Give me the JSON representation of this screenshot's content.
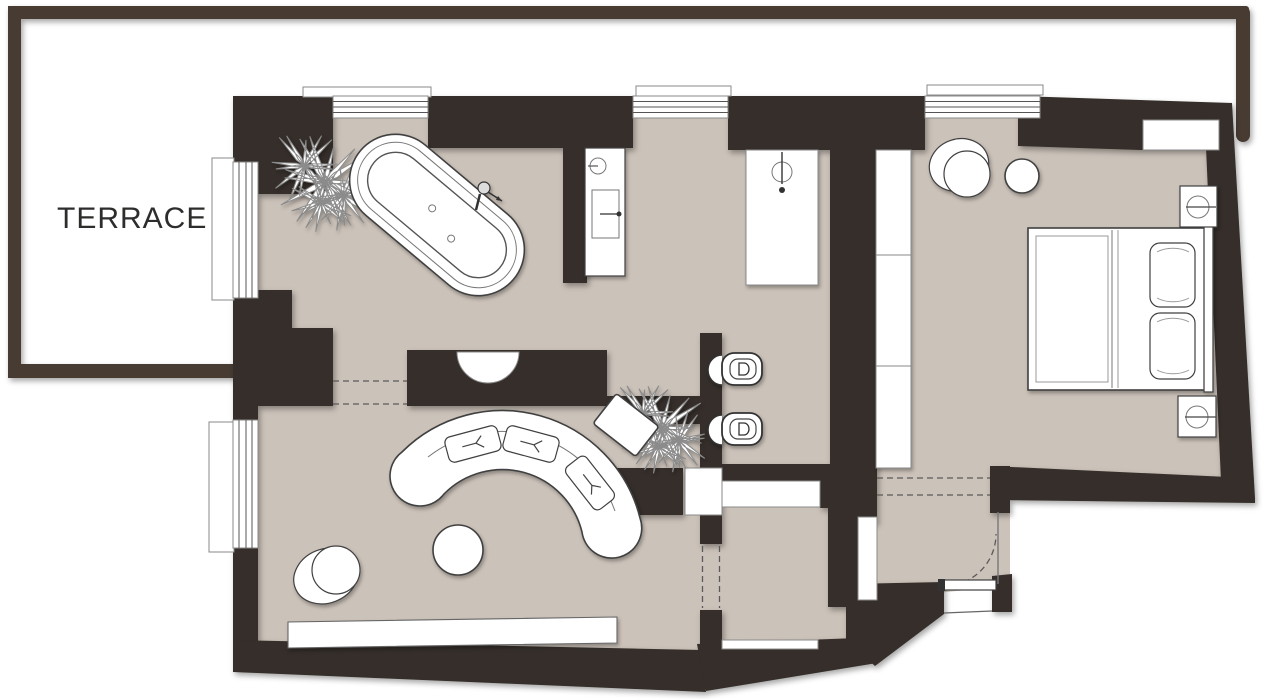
{
  "labels": {
    "terrace": "TERRACE"
  },
  "colors": {
    "wall": "#362f29",
    "terrace_wall": "#473a31",
    "floor": "#cbc2b9",
    "background": "#ffffff",
    "fixture_stroke": "#3f3f3f",
    "label_text": "#2e2d2b"
  },
  "plan": {
    "type": "apartment-floor-plan",
    "areas": [
      {
        "id": "terrace",
        "label": "TERRACE"
      },
      {
        "id": "bathroom",
        "fixtures": [
          "plant",
          "freestanding-bathtub",
          "bathtub-faucet",
          "vanity-sink",
          "wall-niche"
        ]
      },
      {
        "id": "shower-wc",
        "fixtures": [
          "shower-column",
          "wall-hung-toilet",
          "bidet",
          "plant"
        ]
      },
      {
        "id": "living-room",
        "fixtures": [
          "curved-sofa",
          "seat-cushion",
          "seat-cushion",
          "seat-cushion",
          "rotated-side-table",
          "round-pouf",
          "armchair",
          "sideboard"
        ]
      },
      {
        "id": "bedroom",
        "fixtures": [
          "armchair",
          "round-side-table",
          "wardrobe",
          "double-bed",
          "pillow",
          "pillow",
          "nightstand-lamp",
          "nightstand-lamp",
          "wall-niche"
        ]
      },
      {
        "id": "hall",
        "fixtures": [
          "pocket-door",
          "threshold-door"
        ]
      },
      {
        "id": "entry",
        "fixtures": [
          "entry-door-swing"
        ]
      }
    ],
    "windows": 5,
    "openings": [
      "bathroom-living-dashed",
      "living-hall-dashed",
      "entry-bedroom-dashed",
      "wc-open-door",
      "hall-entry-doorway",
      "entry-door"
    ]
  }
}
